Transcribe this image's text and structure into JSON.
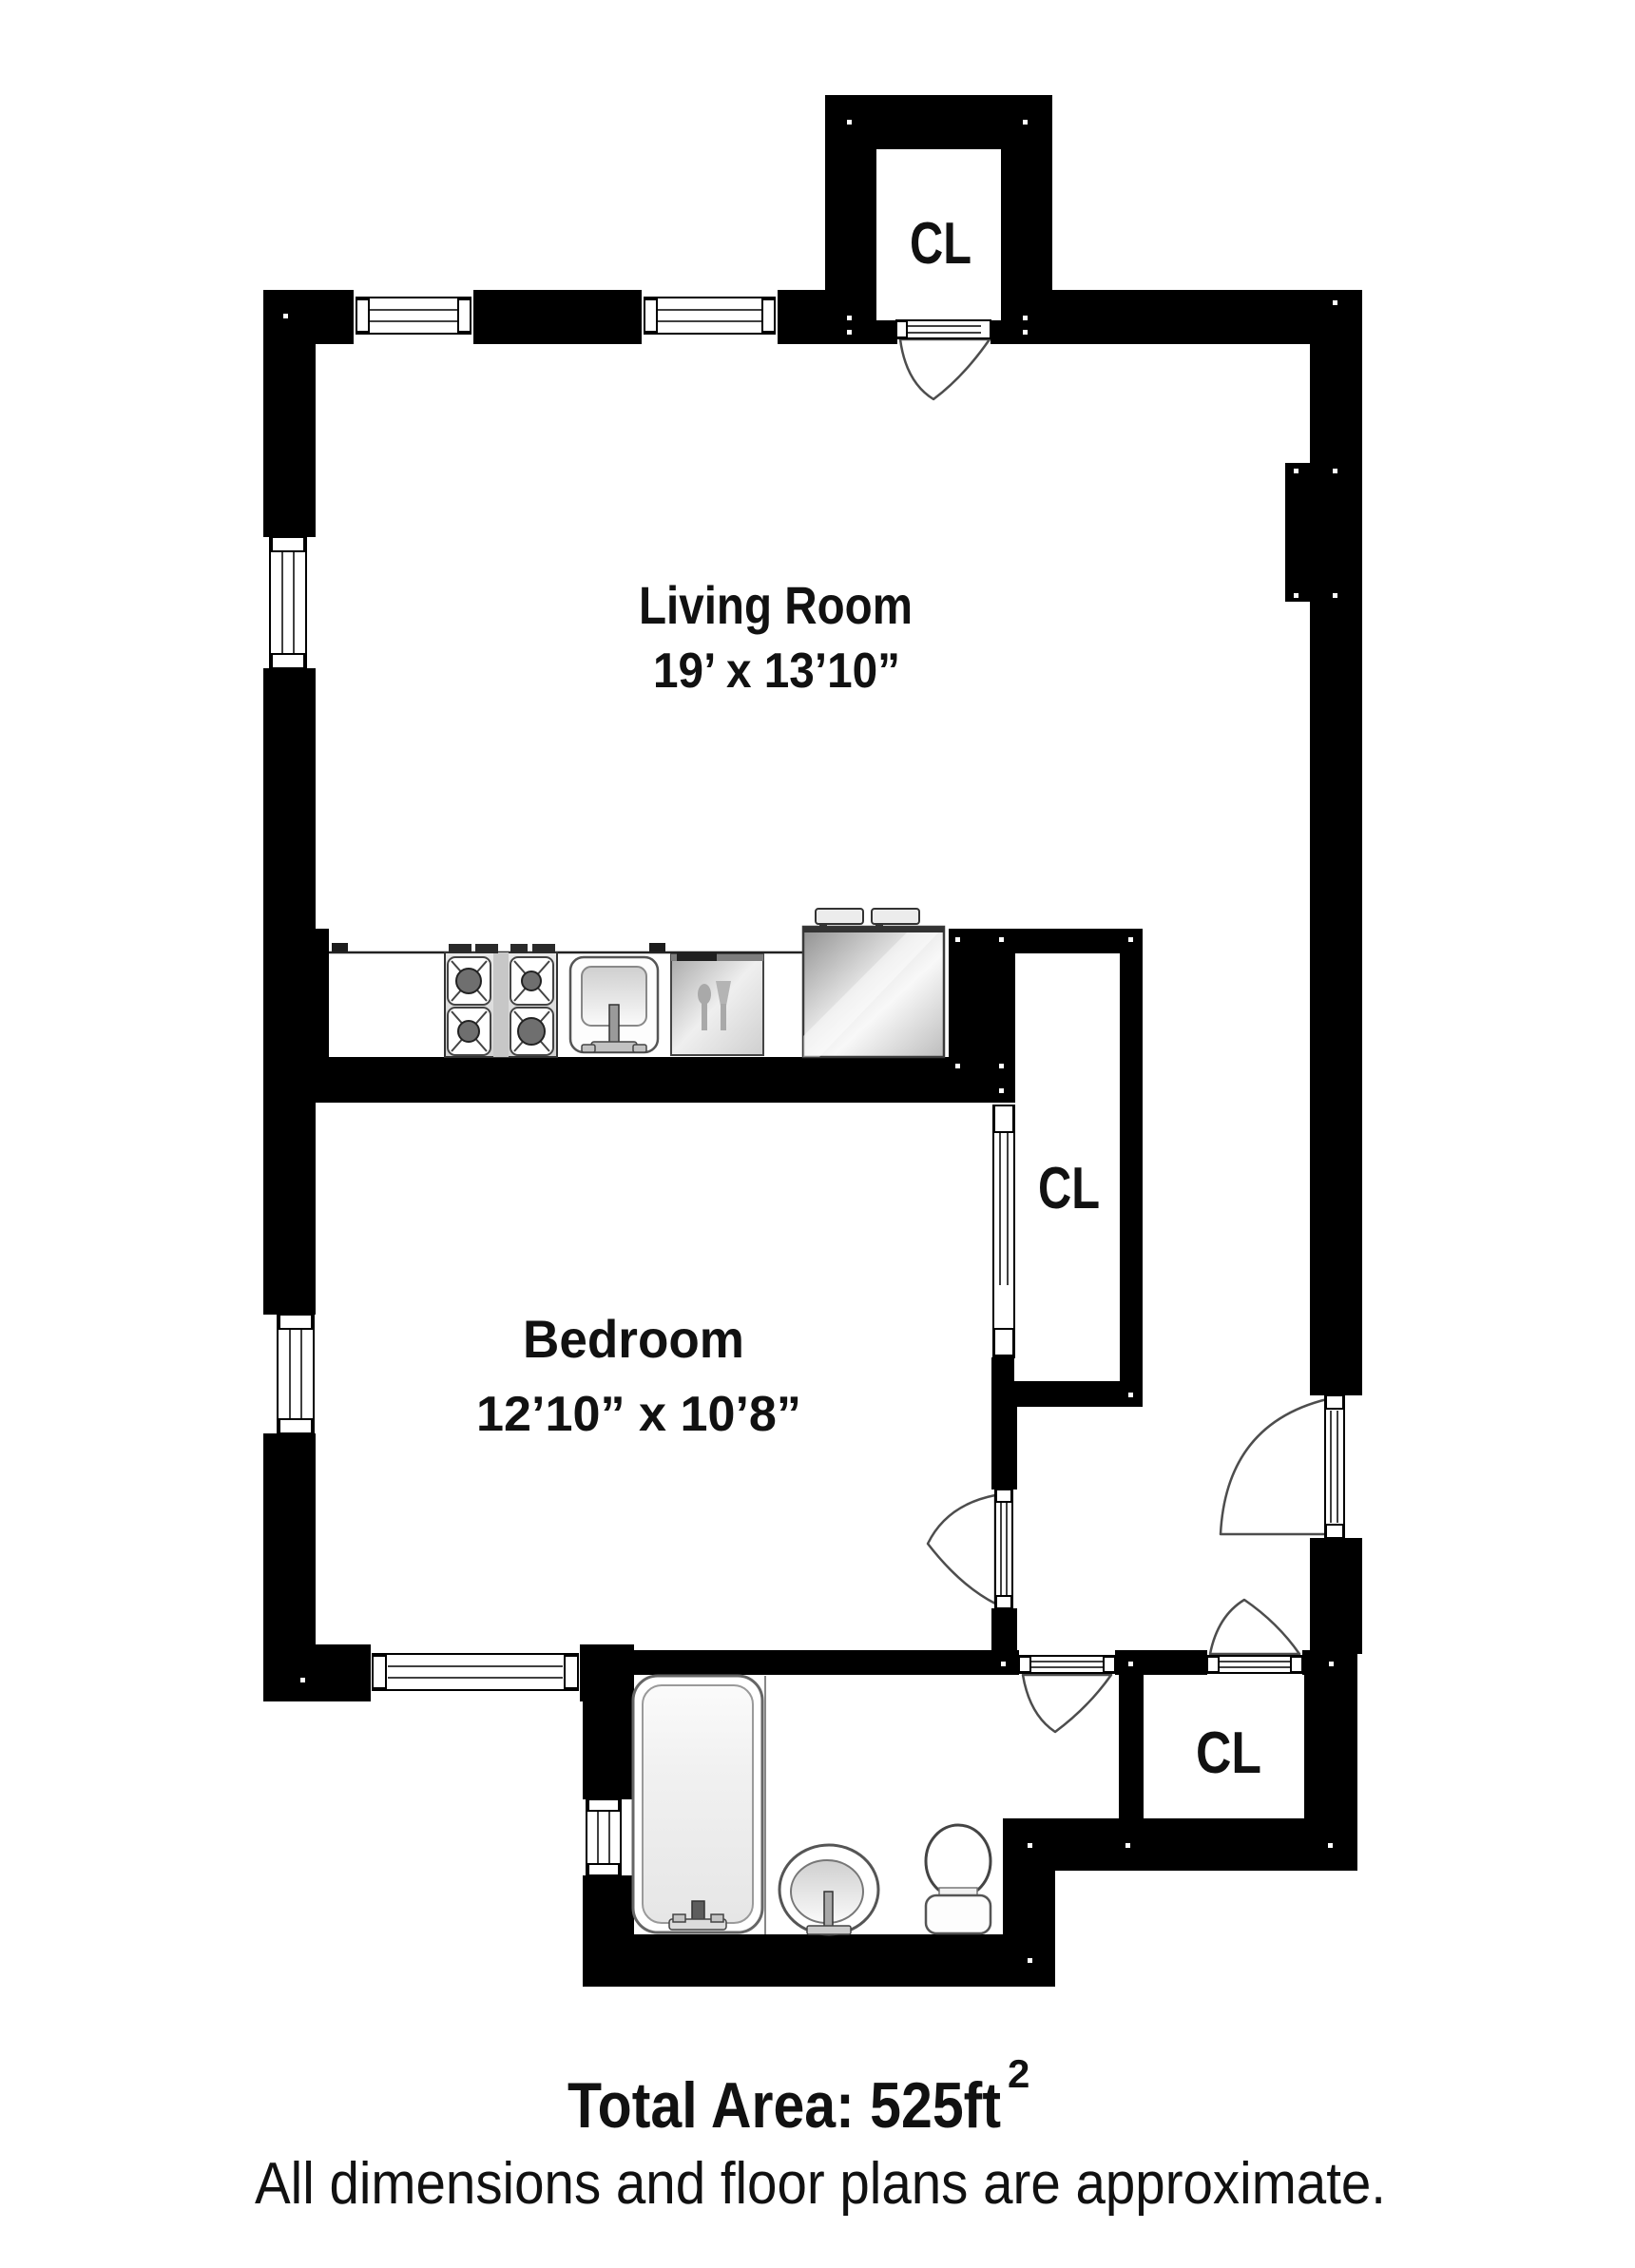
{
  "page": {
    "background": "#ffffff",
    "wall_color": "#000000",
    "fixture_gray": "#d9d9d9"
  },
  "rooms": {
    "living_room": {
      "name": "Living Room",
      "dimensions": "19’ x 13’10”"
    },
    "bedroom": {
      "name": "Bedroom",
      "dimensions": "12’10” x 10’8”"
    },
    "closet_top": {
      "label": "CL"
    },
    "closet_middle": {
      "label": "CL"
    },
    "closet_bottom": {
      "label": "CL"
    }
  },
  "fixtures": {
    "kitchen_icons": [
      "stove-burners-icon",
      "kitchen-sink-icon",
      "dishwasher-icon",
      "refrigerator-icon"
    ],
    "bathroom_icons": [
      "bathtub-icon",
      "bathroom-sink-icon",
      "toilet-icon"
    ],
    "opening_icons": [
      "window-icon",
      "door-swing-icon",
      "sliding-door-icon"
    ]
  },
  "footer": {
    "total_area_text": "Total Area: 525ft",
    "total_area_sup": "2",
    "disclaimer": "All dimensions and floor plans are approximate."
  }
}
